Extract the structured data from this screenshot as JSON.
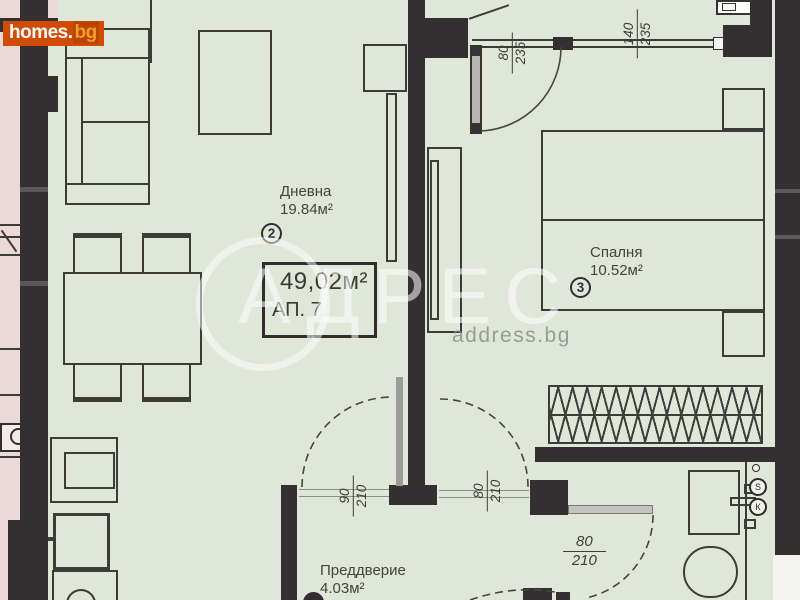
{
  "site": {
    "logo_text": "homes.",
    "logo_suffix": "bg"
  },
  "watermark": {
    "brand": "АДРЕС",
    "url": "address.bg"
  },
  "apartment": {
    "area": "49,02м²",
    "number_label": "АП. 7"
  },
  "rooms": {
    "living": {
      "name": "Дневна",
      "area": "19.84м²",
      "number": "2"
    },
    "bedroom": {
      "name": "Спалня",
      "area": "10.52м²",
      "number": "3"
    },
    "hall": {
      "name": "Преддверие",
      "area": "4.03м²"
    }
  },
  "dimensions": {
    "bedroom_door": {
      "w": "80",
      "h": "235"
    },
    "bedroom_window": {
      "w": "140",
      "h": "235"
    },
    "living_door": {
      "w": "90",
      "h": "210"
    },
    "hall_bedroom_door": {
      "w": "80",
      "h": "210"
    },
    "bath_door": {
      "w": "80",
      "h": "210"
    }
  },
  "fixtures": {
    "meter_top_glyph": "Ѕ",
    "meter_bottom_glyph": "К"
  },
  "colors": {
    "wall": "#342f31",
    "floor": "#dfe7d9",
    "outside": "#ead9d7",
    "logo_bg": "#d14b02",
    "watermark": "#ffffff"
  }
}
